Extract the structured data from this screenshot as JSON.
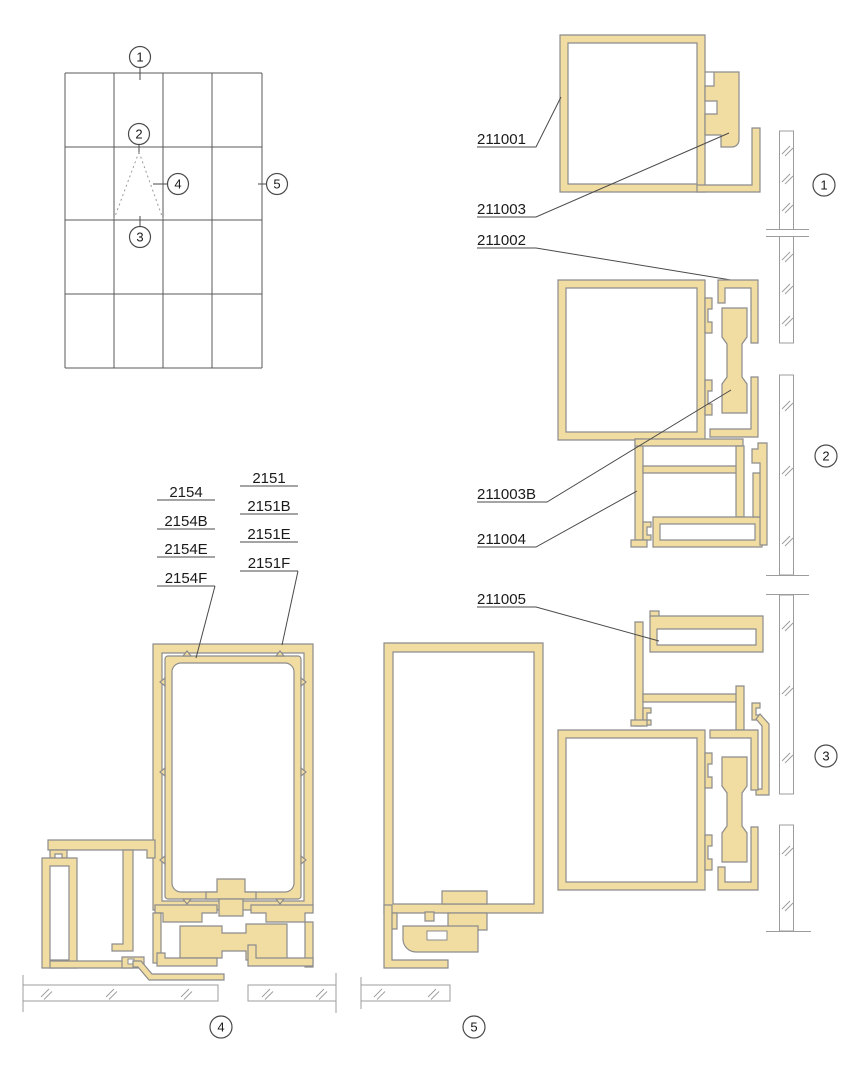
{
  "colors": {
    "background": "#FFFFFF",
    "profile_fill": "#F1DCA2",
    "profile_stroke": "#8C8C8C",
    "line": "#4A4A4A",
    "glass_stroke": "#9C9C9C",
    "text": "#1A1A1A"
  },
  "markers": {
    "m1": "1",
    "m2": "2",
    "m3": "3",
    "m4": "4",
    "m5": "5"
  },
  "part_labels": {
    "p211001": "211001",
    "p211002": "211002",
    "p211003": "211003",
    "p211003b": "211003B",
    "p211004": "211004",
    "p211005": "211005"
  },
  "stacks": {
    "s2154": [
      "2154",
      "2154B",
      "2154E",
      "2154F"
    ],
    "s2151": [
      "2151",
      "2151B",
      "2151E",
      "2151F"
    ]
  }
}
